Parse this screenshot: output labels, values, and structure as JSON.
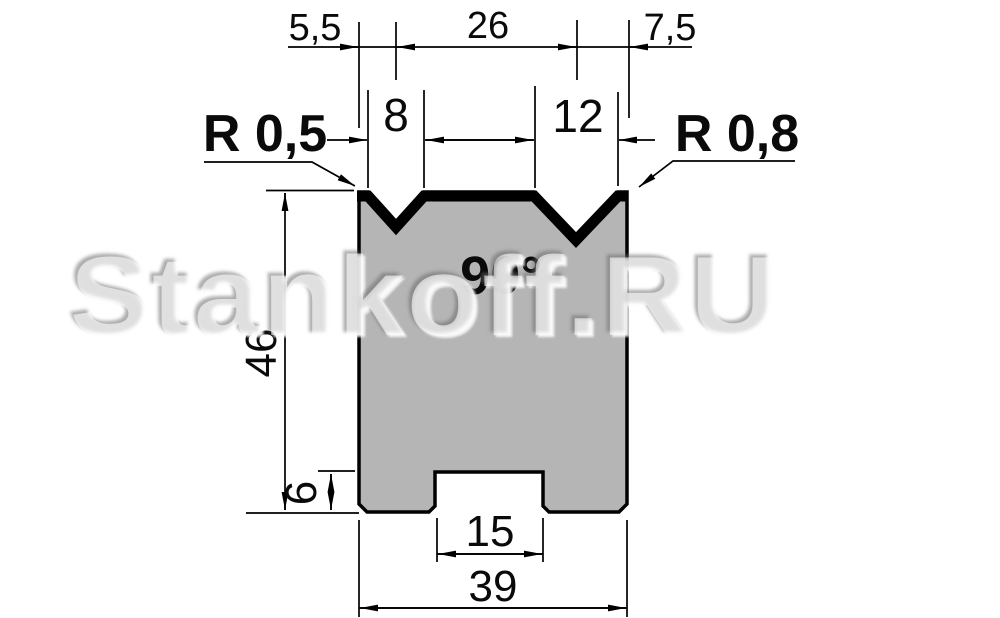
{
  "drawing": {
    "watermark": "Stankoff.RU",
    "angle_label": "90°",
    "radius_left": "R 0,5",
    "radius_right": "R 0,8",
    "dims": {
      "offset_left": "5,5",
      "vee_spacing": "26",
      "offset_right": "7,5",
      "vee_left_width": "8",
      "vee_right_width": "12",
      "body_height": "46",
      "foot_height": "6",
      "slot_width": "15",
      "body_width": "39"
    },
    "colors": {
      "body_fill": "#b5b5b5",
      "line": "#000000",
      "background": "#ffffff"
    }
  }
}
